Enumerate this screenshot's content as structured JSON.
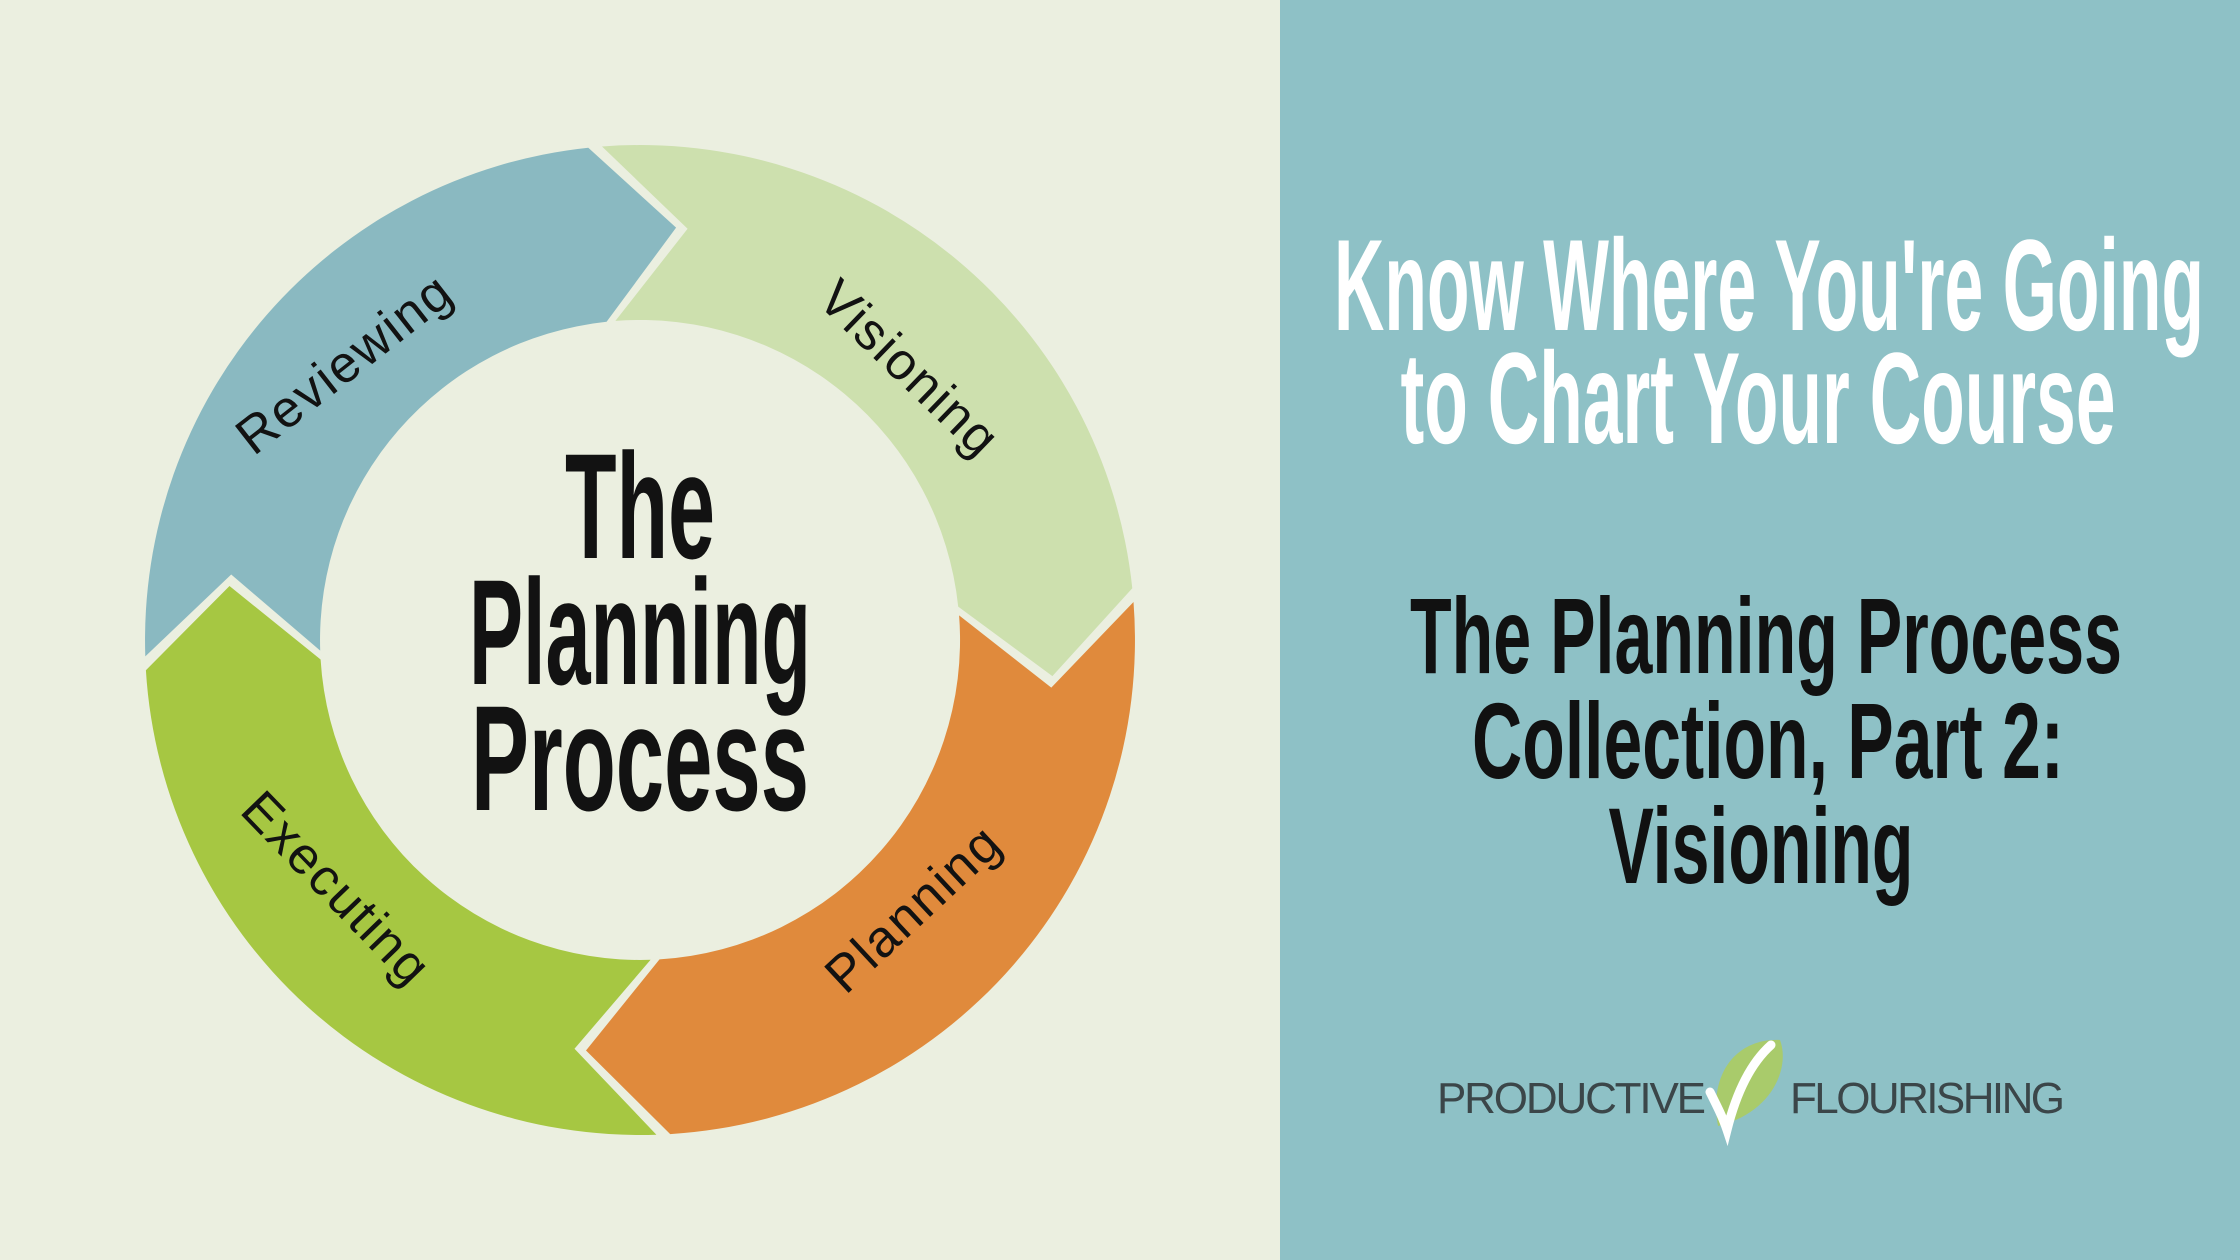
{
  "colors": {
    "left_background": "#ebefe0",
    "right_background": "#8ec1c6",
    "center_title_ink": "#121212",
    "arc_label_ink": "#121212",
    "heading_primary_ink": "#ffffff",
    "heading_secondary_ink": "#111111",
    "logo_text_ink": "#3b4649",
    "logo_leaf_green": "#a9cb6b",
    "logo_check_white": "#ffffff"
  },
  "diagram": {
    "center_title_lines": [
      "The",
      "Planning",
      "Process"
    ],
    "segments": [
      {
        "id": "visioning",
        "label": "Visioning",
        "color": "#cde0ae"
      },
      {
        "id": "planning",
        "label": "Planning",
        "color": "#e08a3c"
      },
      {
        "id": "executing",
        "label": "Executing",
        "color": "#a6c742"
      },
      {
        "id": "reviewing",
        "label": "Reviewing",
        "color": "#8ab9c1"
      }
    ]
  },
  "right_panel": {
    "heading_primary_lines": [
      "Know Where You're Going",
      "to Chart Your Course"
    ],
    "heading_secondary_lines": [
      "The Planning Process",
      "Collection, Part 2:",
      "Visioning"
    ],
    "logo": {
      "word_left": "PRODUCTIVE",
      "word_right": "FLOURISHING"
    }
  }
}
